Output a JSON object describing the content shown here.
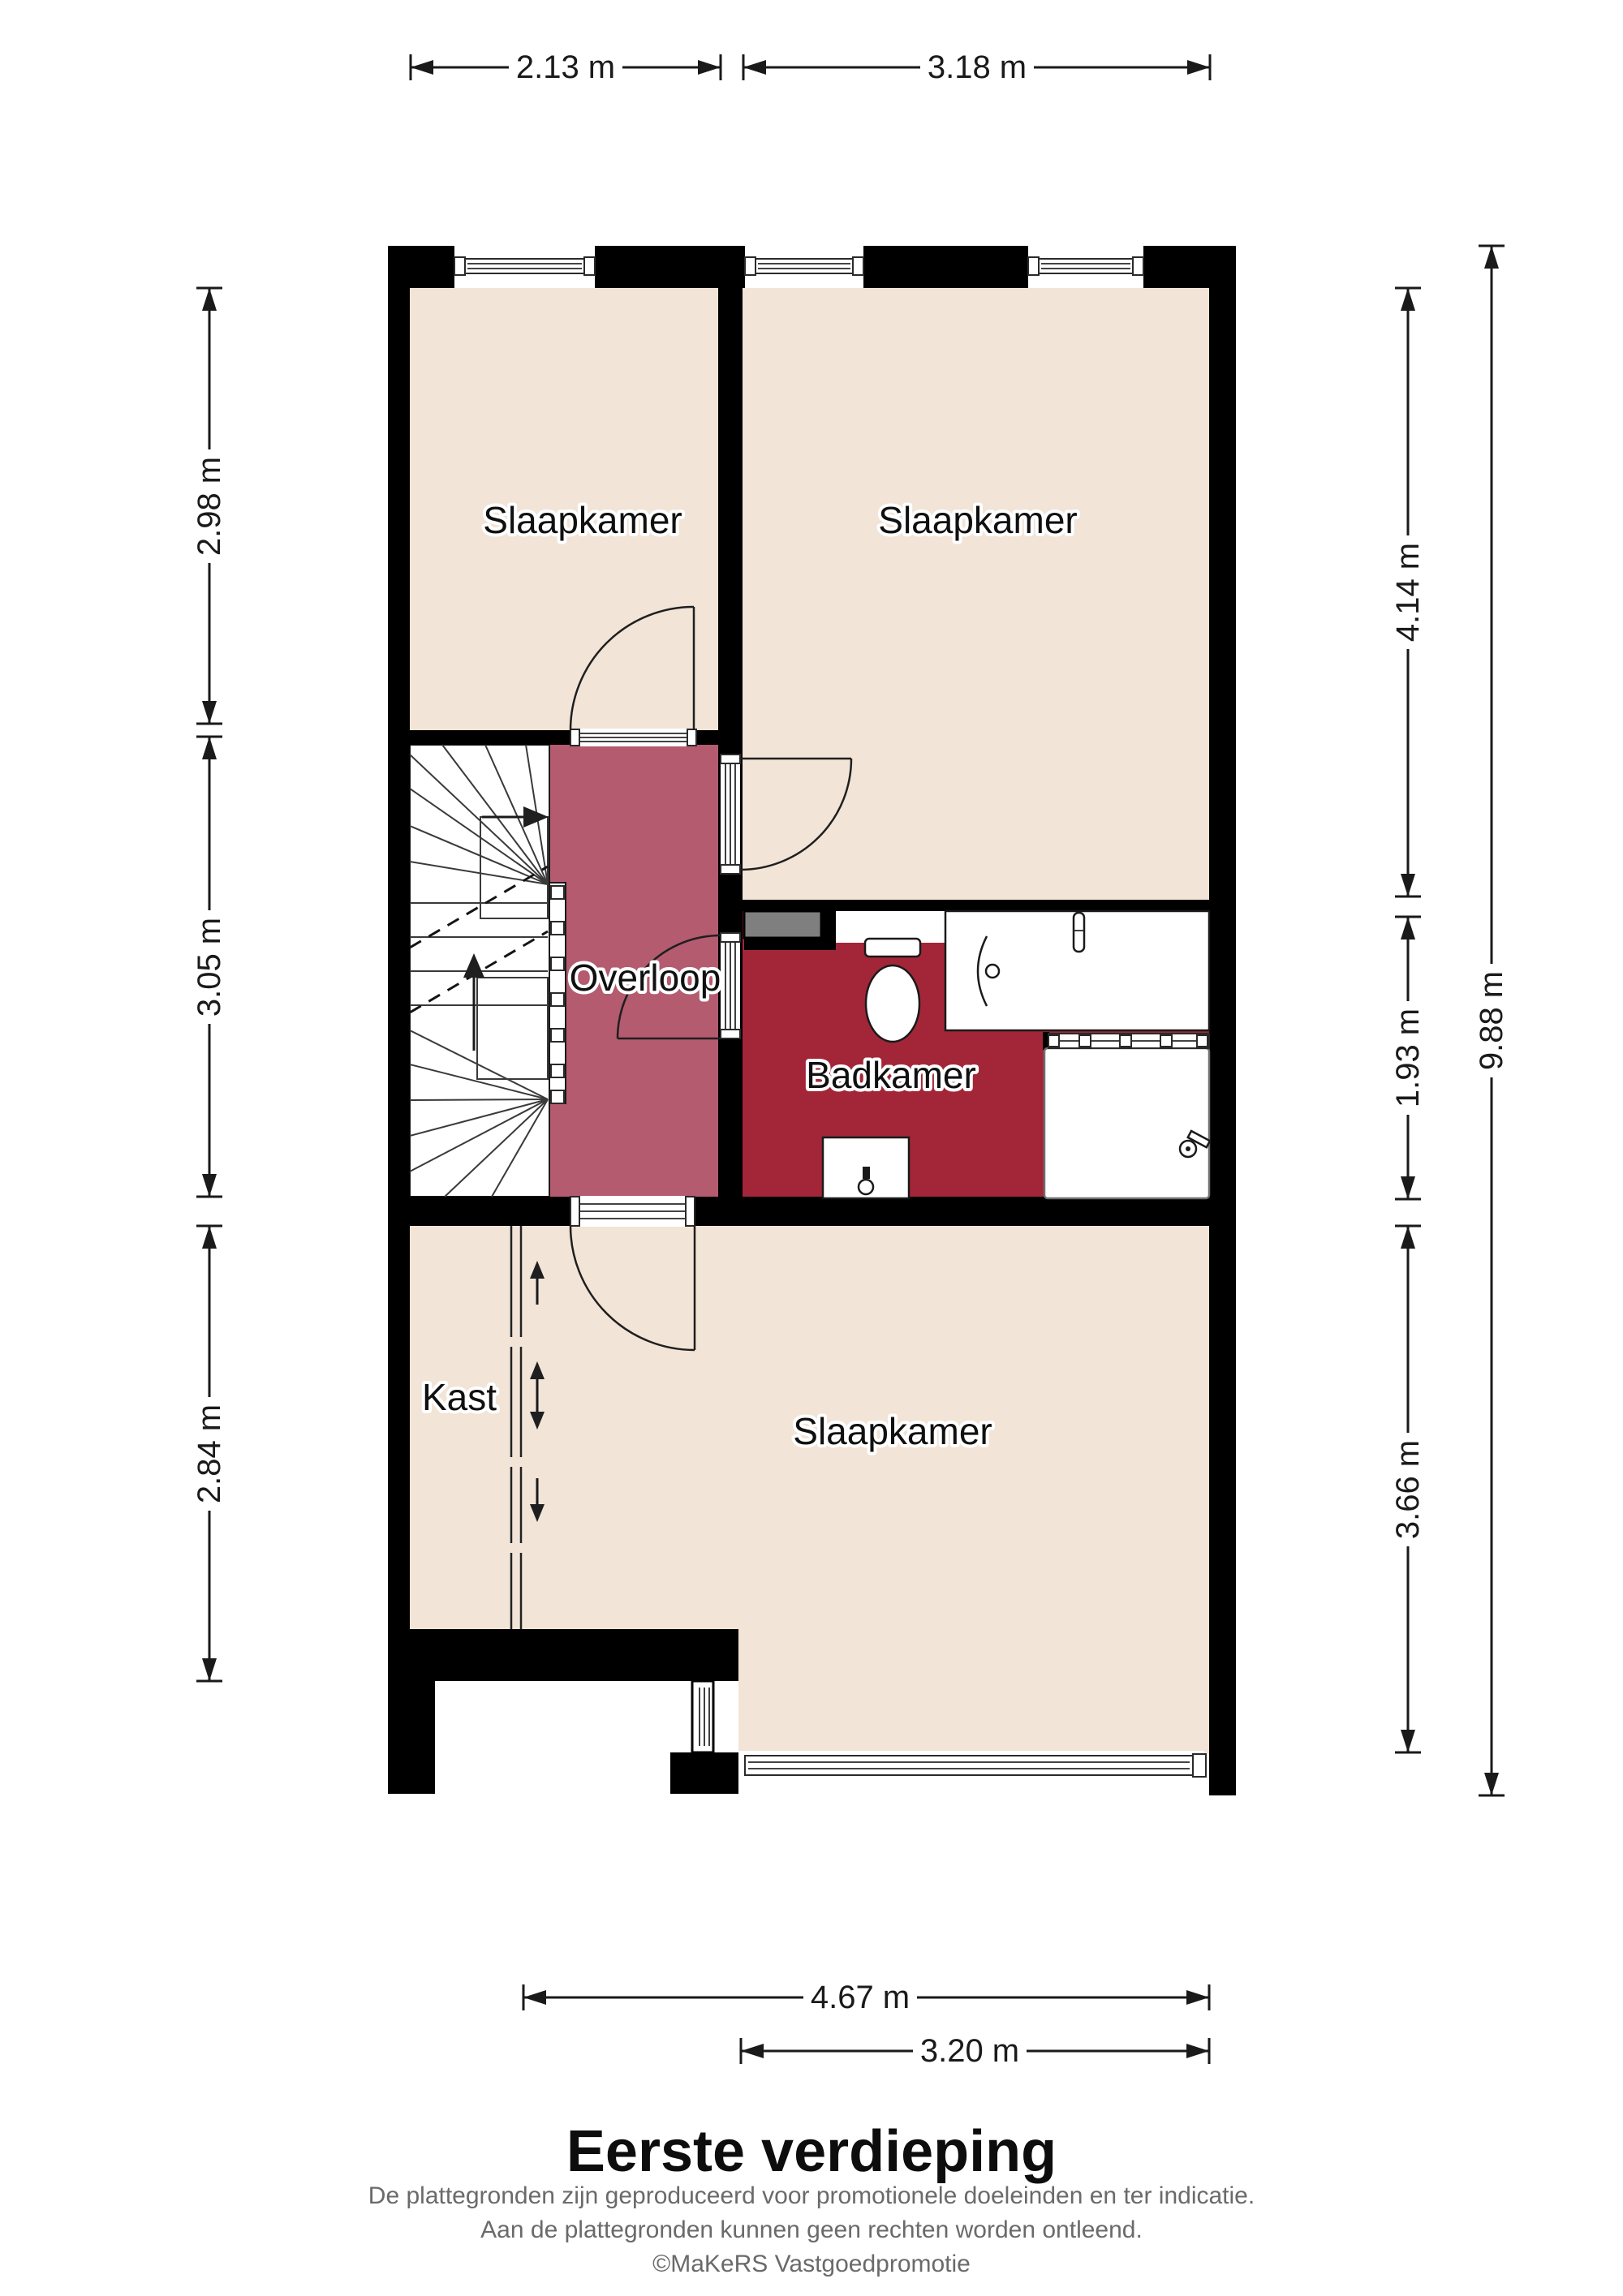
{
  "page": {
    "title": "Eerste verdieping",
    "disclaimer": [
      "De plattegronden zijn geproduceerd voor promotionele doeleinden en ter indicatie.",
      "Aan de plattegronden kunnen geen rechten worden ontleend."
    ],
    "credit": "©MaKeRS Vastgoedpromotie"
  },
  "rooms": {
    "bedroom_top_left": "Slaapkamer",
    "bedroom_top_right": "Slaapkamer",
    "bedroom_bottom": "Slaapkamer",
    "landing": "Overloop",
    "bathroom": "Badkamer",
    "closet": "Kast"
  },
  "dimensions": {
    "top": [
      "2.13 m",
      "3.18 m"
    ],
    "left": [
      "2.98 m",
      "3.05 m",
      "2.84 m"
    ],
    "right_inner": [
      "4.14 m",
      "1.93 m",
      "3.66 m"
    ],
    "right_outer": [
      "9.88 m"
    ],
    "bottom": [
      "4.67 m",
      "3.20 m"
    ]
  },
  "colors": {
    "background": "#ffffff",
    "wall": "#000000",
    "floor": "#f2e4d7",
    "landing": "#b45b70",
    "bathroom": "#a32638",
    "duct": "#7f7f7f",
    "stair": "#ffffff",
    "dim_text": "#1a1a1a",
    "label_text": "#101010",
    "title_text": "#0d0d0d",
    "footer_text": "#6a6a6a"
  }
}
